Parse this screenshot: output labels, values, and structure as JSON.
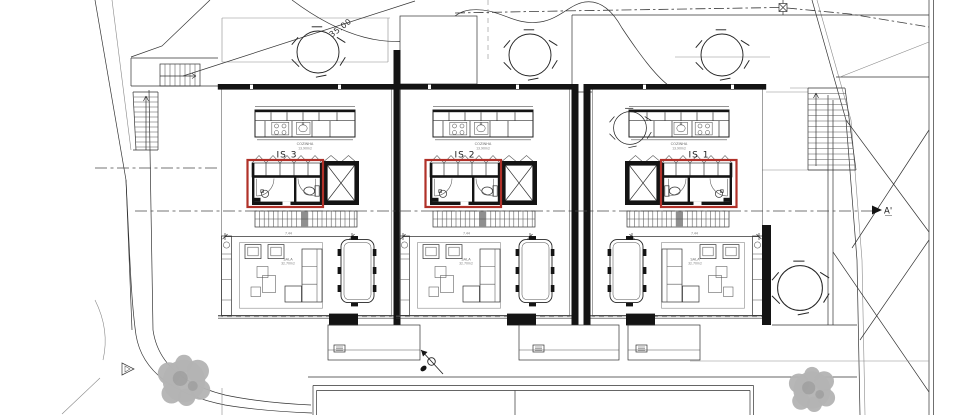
{
  "site": {
    "dimension_label": "35.00",
    "section_marker": "A'"
  },
  "colors": {
    "highlight_red": "#b03129",
    "wall_black": "#141414",
    "line_gray": "#333333",
    "tread_gray": "#8f8f8f",
    "tree_gray": "#b3b3b3",
    "background": "#ffffff"
  },
  "units": [
    {
      "name": "house-3",
      "bath_label": "IS 3",
      "kitchen_label": "COZINHA",
      "kitchen_area": "13.90m2",
      "living_label": "SALA",
      "living_area": "32.70m2",
      "width_dim": "7.44"
    },
    {
      "name": "house-2",
      "bath_label": "IS 2",
      "kitchen_label": "COZINHA",
      "kitchen_area": "13.90m2",
      "living_label": "SALA",
      "living_area": "32.70m2",
      "width_dim": "7.44"
    },
    {
      "name": "house-1",
      "bath_label": "IS 1",
      "kitchen_label": "COZINHA",
      "kitchen_area": "13.90m2",
      "living_label": "SALA",
      "living_area": "32.70m2",
      "width_dim": "7.44"
    }
  ]
}
